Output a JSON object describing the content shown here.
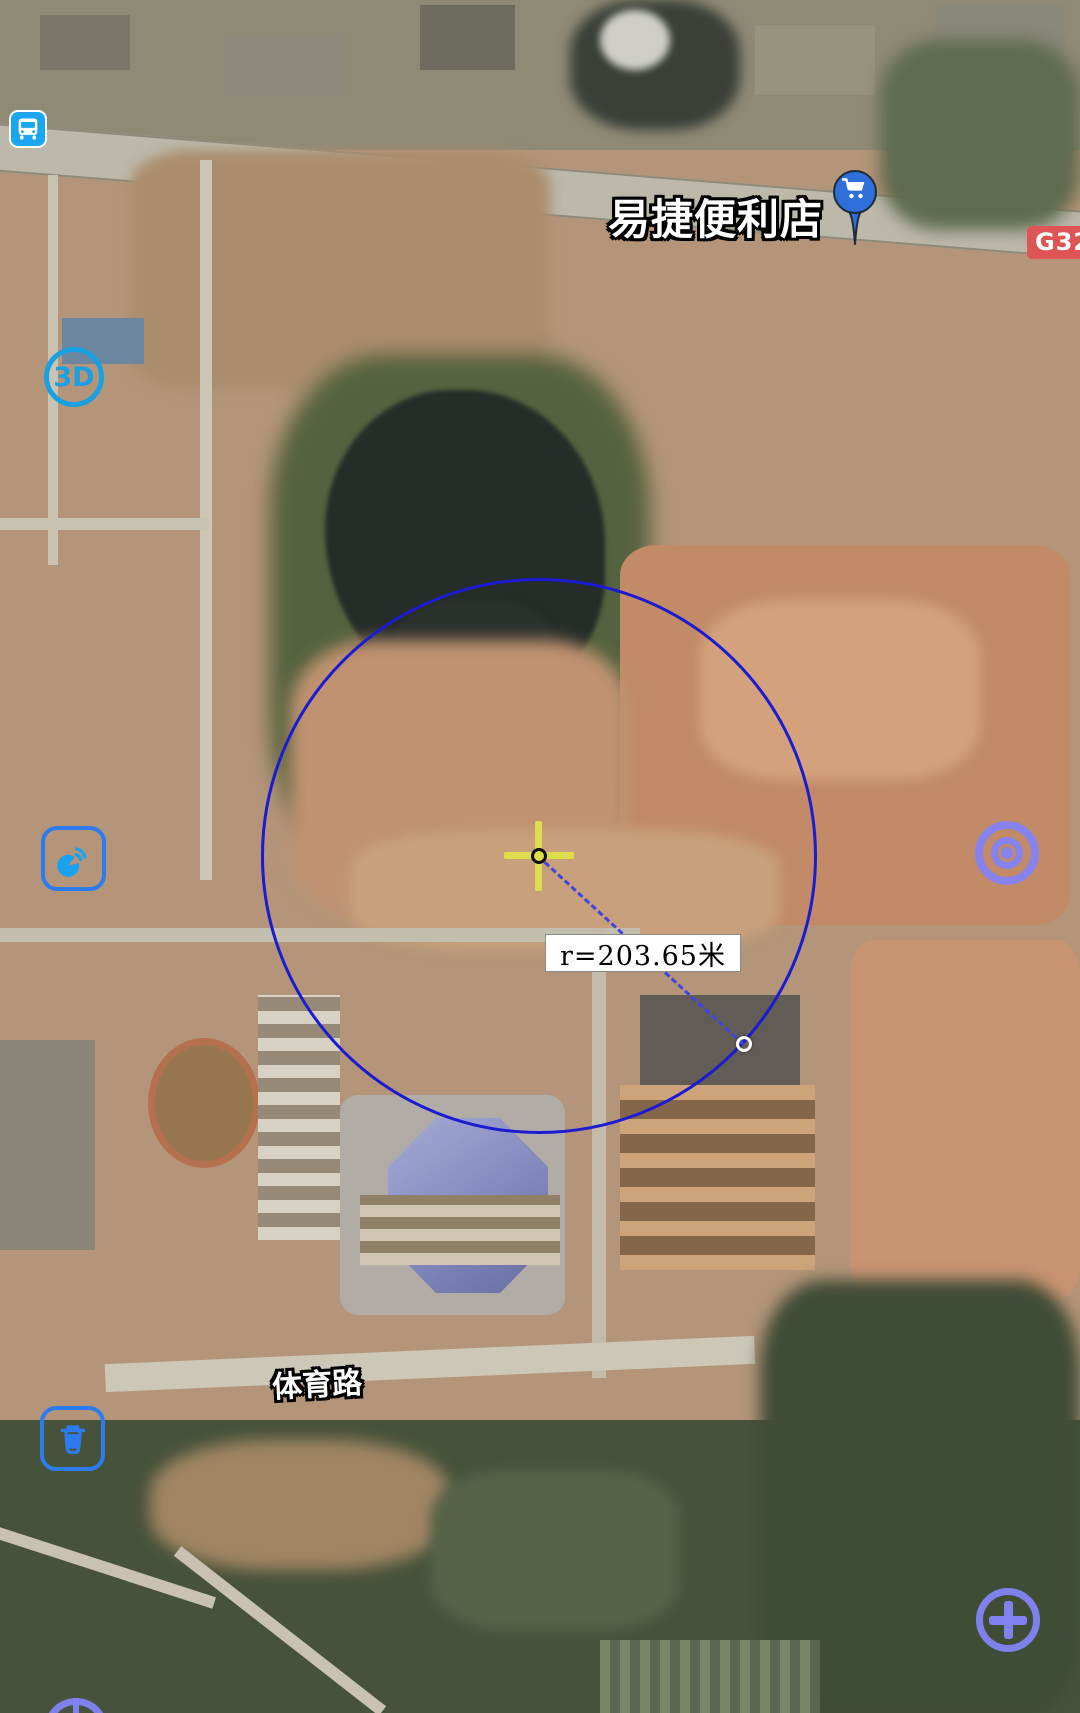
{
  "poi": {
    "name": "易捷便利店",
    "icon": "shopping-cart-pin",
    "pin_color": "#2e6fd9"
  },
  "highway_badge": {
    "label": "G32",
    "color": "#df5555"
  },
  "road_name": {
    "label": "体育路"
  },
  "measurement": {
    "radius_label": "r=203.65米",
    "circle_color": "#1b1bd2",
    "crosshair_color": "#dede4c"
  },
  "controls": {
    "three_d": "3D",
    "bus_icon": "bus-station",
    "satellite_icon": "satellite-signal",
    "locate_icon": "target-rings",
    "trash_icon": "trash-can",
    "zoom_in_icon": "plus",
    "accent_blue": "#1aa7f0",
    "outline_blue": "#2e7bf0",
    "periwinkle": "#8383f5"
  }
}
